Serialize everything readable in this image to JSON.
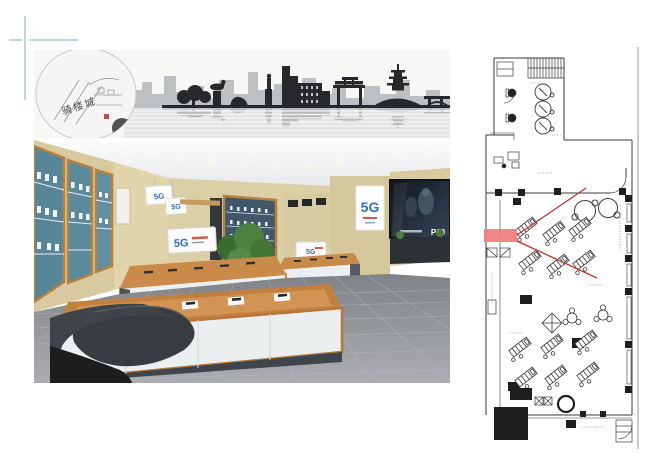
{
  "photo": {
    "mural_calligraphy": "骑楼城",
    "hanging_sign_left": "5G",
    "hanging_sign_right": "5G",
    "table_screen_logo": "5G",
    "far_table_screen_logo": "5G",
    "pillar_poster_logo": "5G",
    "video_wall_label": "P20"
  },
  "colors": {
    "canvas_bg": "#ffffff",
    "guide_blue": "#b7d7e3",
    "divider_gray": "#cbcbcb",
    "plan_line": "#3a3a3a",
    "plan_highlight_red": "#f08080",
    "plan_sightline_red": "#c13333",
    "wall_beige": "#ddcfa6",
    "wood_trim": "#b97a3e",
    "shelf_teal": "#57869a",
    "floor_gray": "#9b9ea3",
    "mural_dark": "#26282b",
    "mural_light": "#b6b9be",
    "logo_blue": "#2e6fbf",
    "logo_red": "#d03a2e",
    "screen_dark": "#1a212b"
  }
}
